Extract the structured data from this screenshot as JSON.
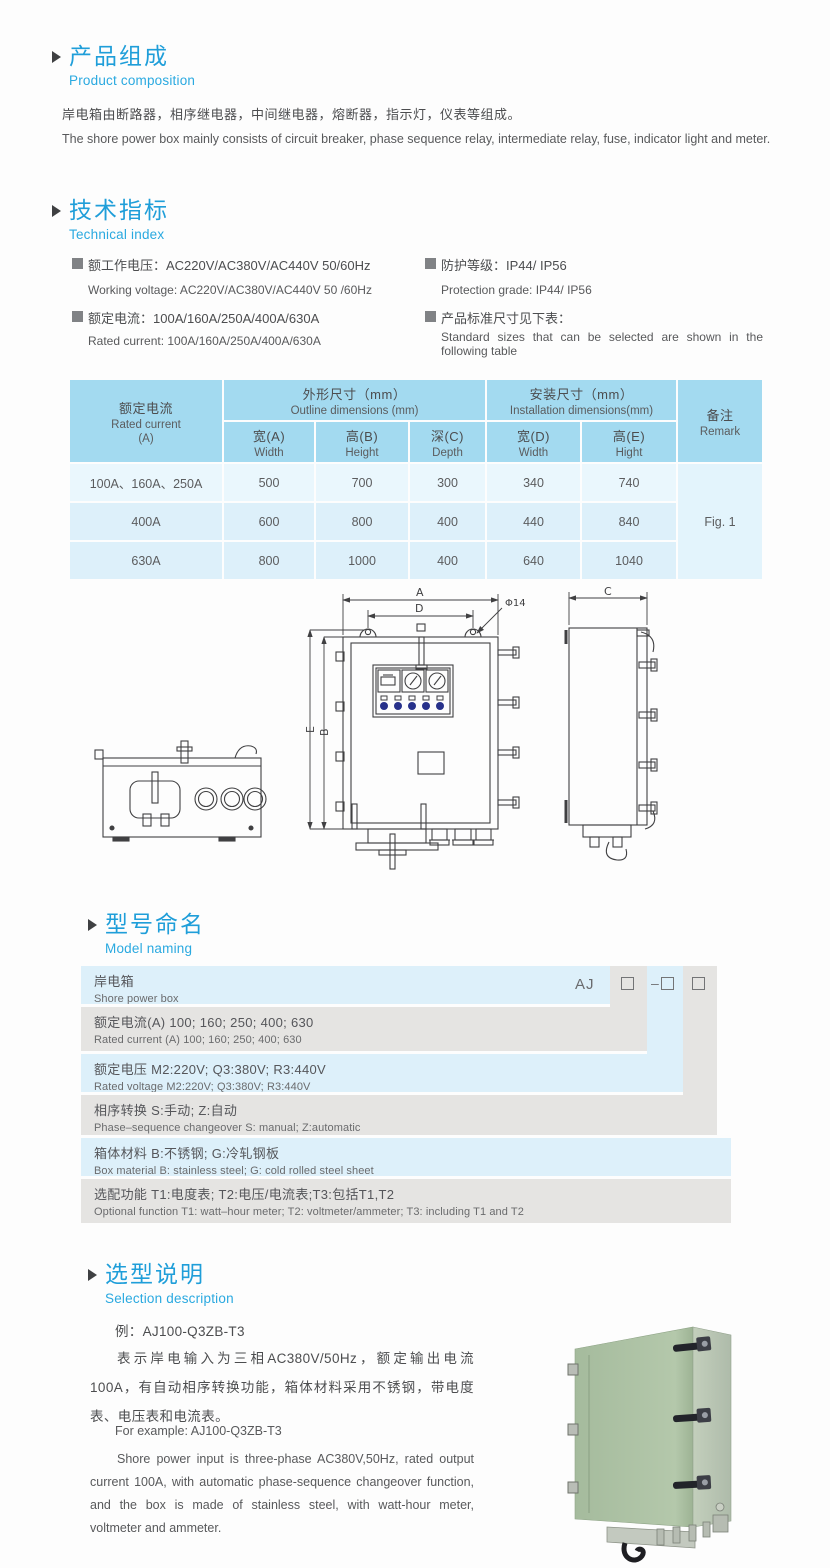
{
  "colors": {
    "accent_blue": "#1f9ed9",
    "subtitle_blue": "#2aa9e0",
    "table_header_bg": "#a3daf0",
    "table_row_light": "#eaf7fd",
    "table_row_dark": "#ddf0fa",
    "band_blue": "#ddf0fa",
    "band_gray": "#e5e4e2",
    "body_text": "#58595b",
    "drawing_stroke": "#404042",
    "photo_green": "#aec2a6"
  },
  "composition": {
    "title_zh": "产品组成",
    "title_en": "Product  composition",
    "body_zh": "岸电箱由断路器，相序继电器，中间继电器，熔断器，指示灯，仪表等组成。",
    "body_en": "The shore power box mainly consists of circuit breaker, phase sequence relay, intermediate relay, fuse, indicator light and meter."
  },
  "technical": {
    "title_zh": "技术指标",
    "title_en": "Technical index",
    "specs": [
      {
        "zh": "额工作电压：AC220V/AC380V/AC440V  50/60Hz",
        "en": "Working voltage: AC220V/AC380V/AC440V 50 /60Hz"
      },
      {
        "zh": "额定电流：100A/160A/250A/400A/630A",
        "en": "Rated current: 100A/160A/250A/400A/630A"
      },
      {
        "zh": "防护等级：IP44/ IP56",
        "en": "Protection grade: IP44/ IP56"
      },
      {
        "zh": "产品标准尺寸见下表：",
        "en": "Standard sizes that can be selected are shown in the following table"
      }
    ]
  },
  "table": {
    "col_current_zh": "额定电流",
    "col_current_en": "Rated current",
    "col_current_unit": "(A)",
    "group_outline_zh": "外形尺寸（mm）",
    "group_outline_en": "Outline dimensions (mm)",
    "group_install_zh": "安装尺寸（mm）",
    "group_install_en": "Installation dimensions(mm)",
    "sub_headers": [
      {
        "zh": "宽(A)",
        "en": "Width"
      },
      {
        "zh": "高(B)",
        "en": "Height"
      },
      {
        "zh": "深(C)",
        "en": "Depth"
      },
      {
        "zh": "宽(D)",
        "en": "Width"
      },
      {
        "zh": "高(E)",
        "en": "Hight"
      }
    ],
    "col_remark_zh": "备注",
    "col_remark_en": "Remark",
    "rows": [
      {
        "current": "100A、160A、250A",
        "w": "500",
        "h": "700",
        "d": "300",
        "iw": "340",
        "ih": "740"
      },
      {
        "current": "400A",
        "w": "600",
        "h": "800",
        "d": "400",
        "iw": "440",
        "ih": "840"
      },
      {
        "current": "630A",
        "w": "800",
        "h": "1000",
        "d": "400",
        "iw": "640",
        "ih": "1040"
      }
    ],
    "remark_value": "Fig. 1"
  },
  "drawing": {
    "dim_a": "A",
    "dim_d": "D",
    "dim_phi": "Φ14",
    "dim_e": "E",
    "dim_b": "B",
    "dim_c": "C"
  },
  "model_naming": {
    "title_zh": "型号命名",
    "title_en": "Model naming",
    "code_prefix": "AJ",
    "box_dash": "–",
    "rows": [
      {
        "zh": "岸电箱",
        "en": "Shore power box"
      },
      {
        "zh": "额定电流(A)  100; 160; 250; 400; 630",
        "en": "Rated current (A) 100; 160; 250; 400; 630"
      },
      {
        "zh": "额定电压   M2:220V;  Q3:380V;  R3:440V",
        "en": "Rated voltage   M2:220V;  Q3:380V;  R3:440V"
      },
      {
        "zh": "相序转换  S:手动; Z:自动",
        "en": "Phase–sequence changeover  S: manual;  Z:automatic"
      },
      {
        "zh": "箱体材料    B:不锈钢;  G:冷轧钢板",
        "en": "Box material   B: stainless steel; G: cold rolled steel sheet"
      },
      {
        "zh": "选配功能      T1:电度表;  T2:电压/电流表;T3:包括T1,T2",
        "en": "Optional function  T1: watt–hour meter; T2: voltmeter/ammeter; T3: including T1 and T2"
      }
    ]
  },
  "selection": {
    "title_zh": "选型说明",
    "title_en": "Selection description",
    "example_zh": "例：AJ100-Q3ZB-T3",
    "body_zh": "表示岸电输入为三相AC380V/50Hz，额定输出电流100A，有自动相序转换功能，箱体材料采用不锈钢，带电度表、电压表和电流表。",
    "example_en": "For example: AJ100-Q3ZB-T3",
    "body_en": "Shore power input is three-phase AC380V,50Hz, rated output current 100A, with automatic phase-sequence changeover function, and the box is made of stainless steel, with watt-hour meter, voltmeter and ammeter."
  }
}
